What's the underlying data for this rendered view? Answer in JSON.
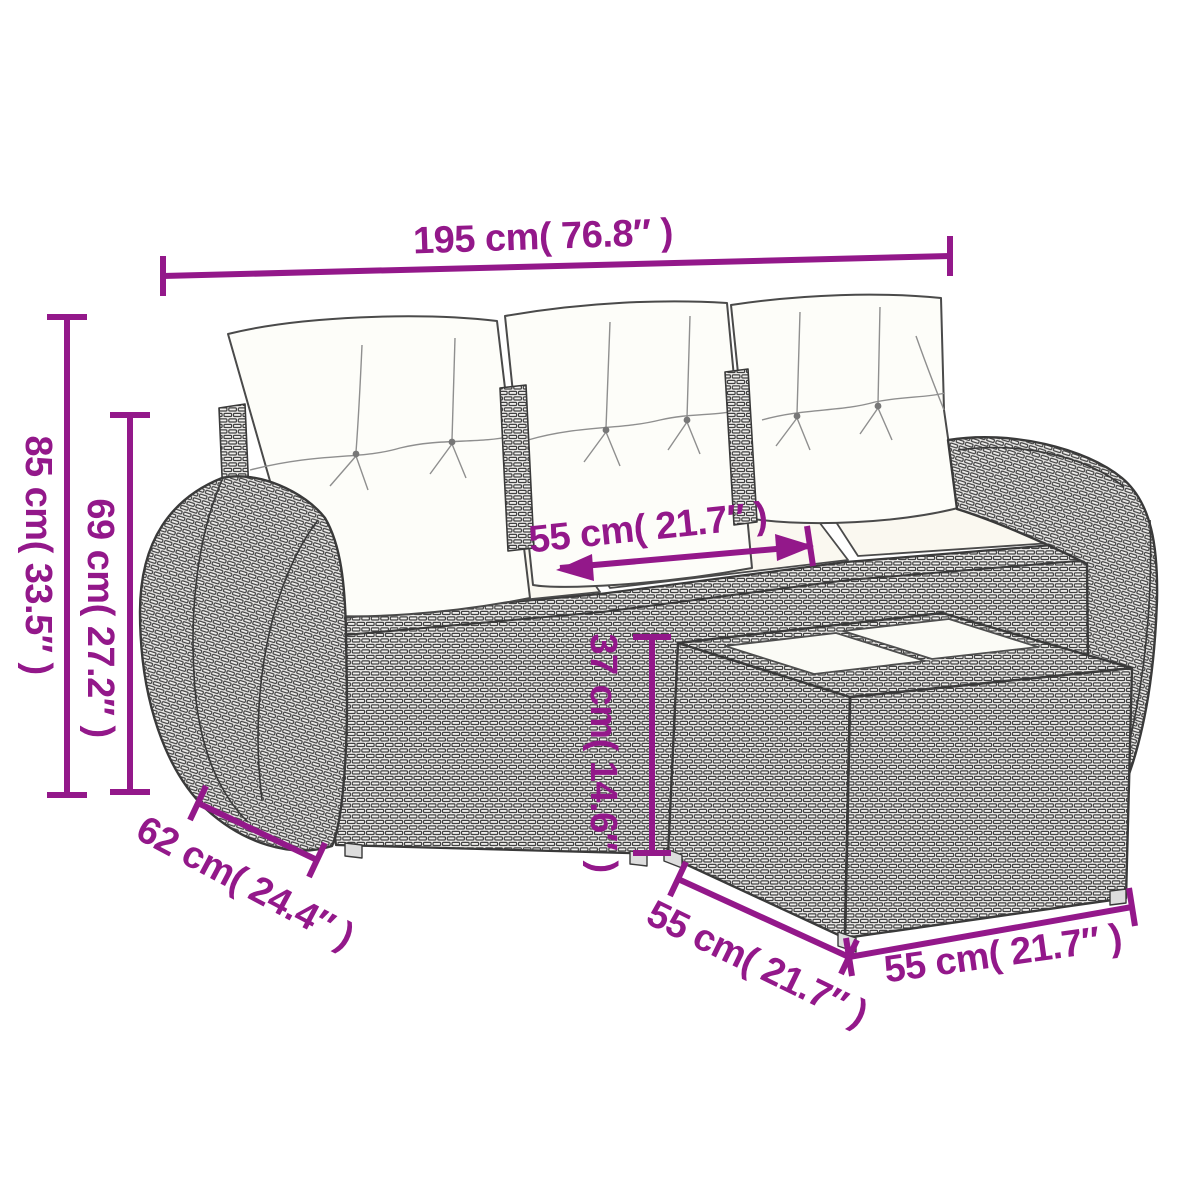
{
  "diagram": {
    "type": "product-dimension-drawing",
    "subject": "rattan garden sofa set with footstool table",
    "colors": {
      "dimension_accent": "#93188a",
      "line_art": "#3a3a3a",
      "wicker_fill": "#efeeec",
      "cushion_white": "#fcfbf6",
      "background": "#ffffff"
    },
    "dimensions": {
      "total_width": "195 cm( 76.8″ )",
      "total_height": "85 cm( 33.5″ )",
      "backrest_height": "69 cm( 27.2″ )",
      "seat_width": "55 cm( 21.7″ )",
      "table_height": "37 cm( 14.6″ )",
      "armrest_depth": "62 cm( 24.4″ )",
      "table_depth": "55 cm( 21.7″ )",
      "table_width": "55 cm( 21.7″ )"
    }
  }
}
